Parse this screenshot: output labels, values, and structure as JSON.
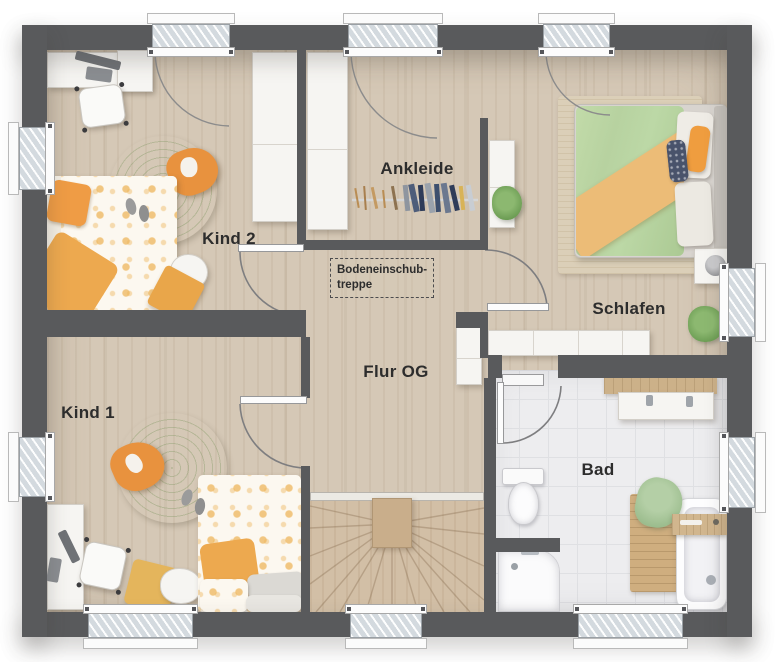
{
  "rooms": {
    "kind2": {
      "label": "Kind 2"
    },
    "kind1": {
      "label": "Kind 1"
    },
    "ankleide": {
      "label": "Ankleide"
    },
    "flur": {
      "label": "Flur OG"
    },
    "schlafen": {
      "label": "Schlafen"
    },
    "bad": {
      "label": "Bad"
    }
  },
  "annotations": {
    "stair_note_line1": "Bodeneinschub-",
    "stair_note_line2": "treppe"
  },
  "palette": {
    "wall": "#595a5c",
    "floor_wood": "#d5c8b6",
    "floor_stairs": "#d2bfa6",
    "floor_tile": "#ededef",
    "rug_green": "#a9c08b",
    "accent_orange": "#e8923e",
    "accent_yellow": "#e4b55c",
    "duvet_green": "#b7d2a0",
    "bedding_orange": "#ecbc77"
  }
}
